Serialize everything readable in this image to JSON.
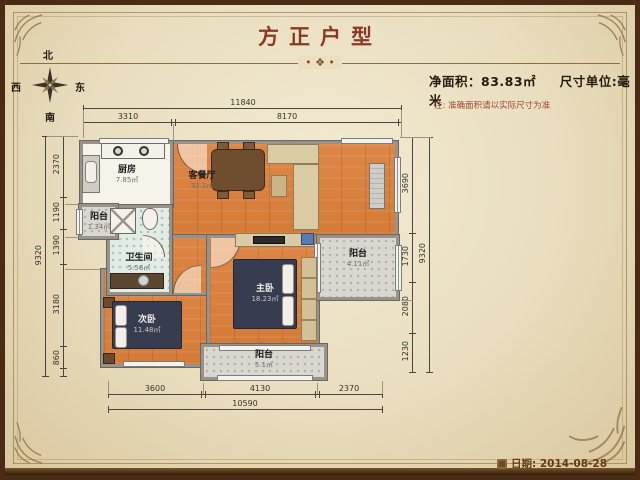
{
  "title": "方正户型",
  "header": {
    "net_area": "净面积：83.83㎡",
    "unit": "尺寸单位:毫米",
    "note": "注: 准确面积请以实际尺寸为准"
  },
  "decor": {
    "divider_ornament": "• ❖ •"
  },
  "compass": {
    "north": "北",
    "south": "南",
    "east": "东",
    "west": "西"
  },
  "rooms": {
    "kitchen": {
      "name": "厨房",
      "area": "7.85㎡"
    },
    "living": {
      "name": "客餐厅",
      "area": "32.2㎡"
    },
    "balcony_left": {
      "name": "阳台",
      "area": "1.34㎡"
    },
    "bathroom": {
      "name": "卫生间",
      "area": "5.56㎡"
    },
    "bedroom_second": {
      "name": "次卧",
      "area": "11.48㎡"
    },
    "bedroom_master": {
      "name": "主卧",
      "area": "18.23㎡"
    },
    "balcony_right": {
      "name": "阳台",
      "area": "4.11㎡"
    },
    "balcony_bottom": {
      "name": "阳台",
      "area": "5.1㎡"
    }
  },
  "dimensions": {
    "top": {
      "total": "11840",
      "segments": [
        "3310",
        "8170"
      ]
    },
    "bottom": {
      "total": "10590",
      "segments": [
        "3600",
        "4130",
        "2370"
      ]
    },
    "left": {
      "total": "9320",
      "segments": [
        "2370",
        "1190",
        "1390",
        "3180",
        "860"
      ]
    },
    "right": {
      "total": "9320",
      "segments": [
        "3690",
        "1730",
        "2080",
        "1230"
      ]
    }
  },
  "footer": {
    "date": "日期: 2014-08-28"
  }
}
